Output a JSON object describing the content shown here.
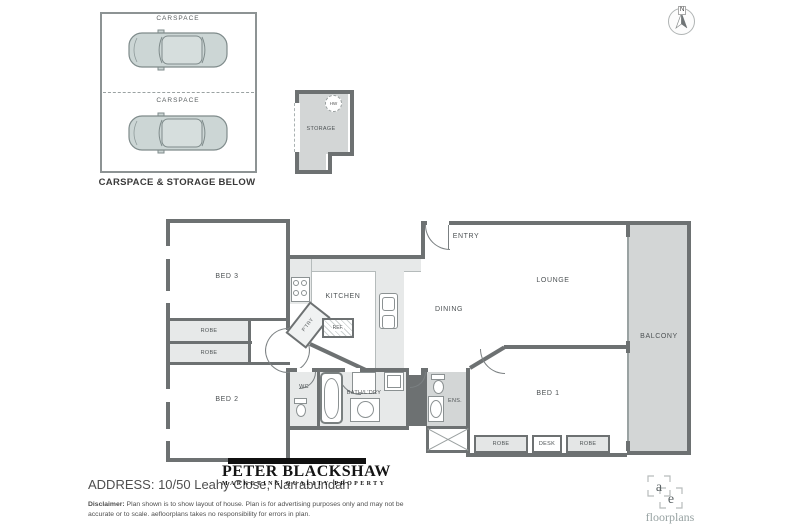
{
  "colors": {
    "wall": "#6d7172",
    "light_fill": "#e7e9e9",
    "mid_fill": "#d3d6d6",
    "car_fill": "#ccd6d5",
    "label_text": "#4d5254",
    "logo_black": "#101010"
  },
  "carspace": {
    "label": "CARSPACE",
    "caption": "CARSPACE & STORAGE BELOW"
  },
  "storage": {
    "label": "STORAGE",
    "hw": "HW"
  },
  "compass": {
    "n": "N"
  },
  "plan": {
    "bed1": "BED 1",
    "bed2": "BED 2",
    "bed3": "BED 3",
    "kitchen": "KITCHEN",
    "dining": "DINING",
    "lounge": "LOUNGE",
    "entry": "ENTRY",
    "balcony": "BALCONY",
    "wc": "WC",
    "bath_ldry": "BATH/L'DRY",
    "ens": "ENS.",
    "pantry": "P'TRY",
    "ref": "REF.",
    "robe": "ROBE",
    "desk": "DESK"
  },
  "footer": {
    "agency_name": "PETER BLACKSHAW",
    "agency_tagline": "MARKETING QUALITY PROPERTY",
    "address": "ADDRESS: 10/50 Leahy Close, Narrabundah",
    "disclaimer_label": "Disclaimer:",
    "disclaimer": "Plan shown is to show layout of house. Plan is for advertising purposes only and may not be accurate or to scale. aefloorplans takes no responsibility for errors in plan.",
    "ae_a": "a",
    "ae_e": "e",
    "ae_name": "floorplans"
  }
}
